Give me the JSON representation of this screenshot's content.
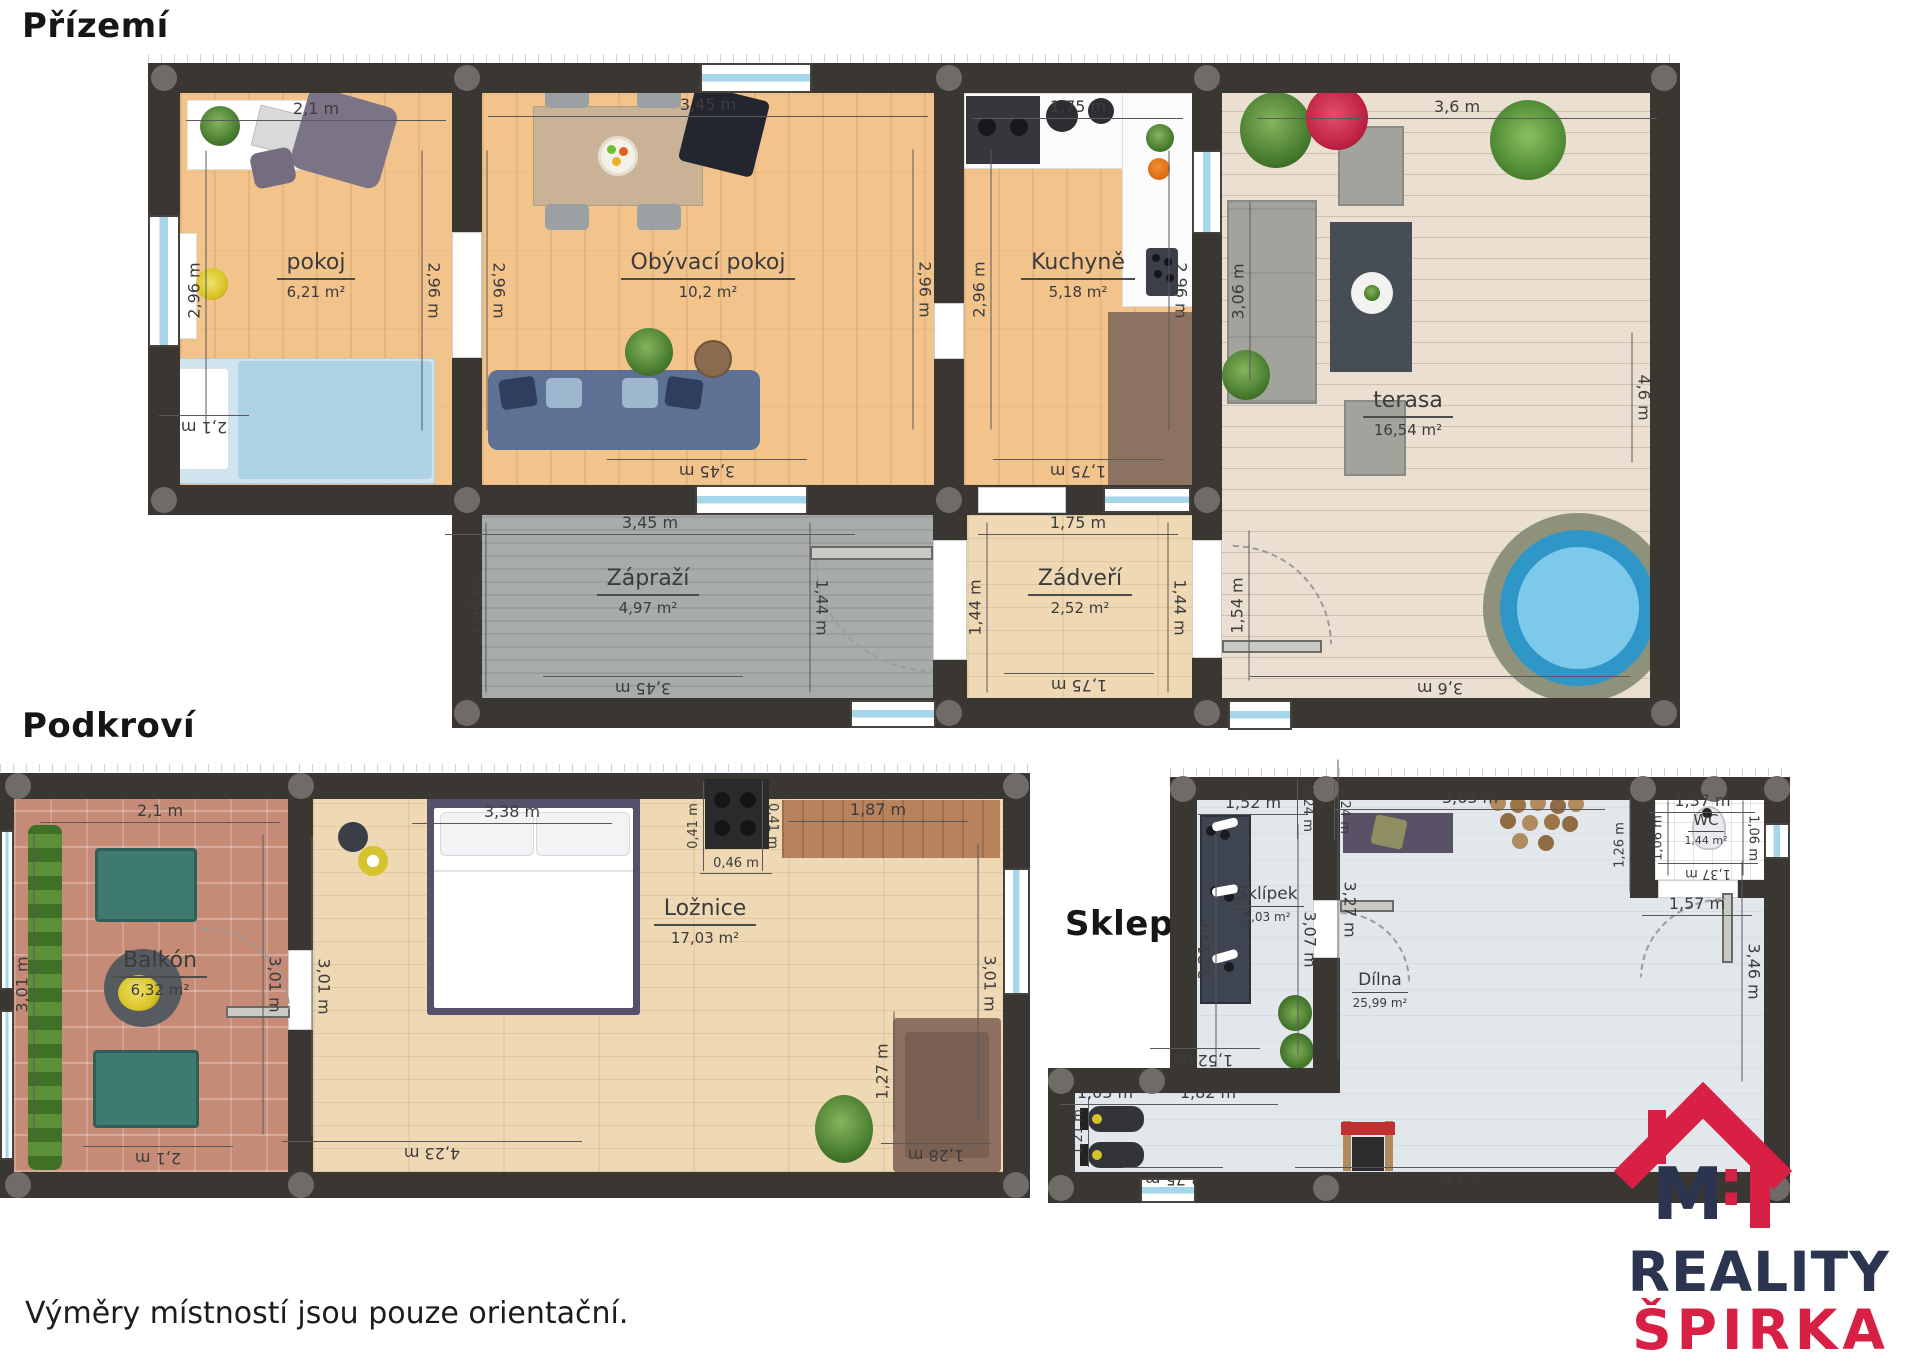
{
  "ground": {
    "title": "Přízemí",
    "rooms": {
      "pokoj": {
        "name": "pokoj",
        "area": "6,21 m²"
      },
      "obyvaci": {
        "name": "Obývací pokoj",
        "area": "10,2 m²"
      },
      "kuchyne": {
        "name": "Kuchyně",
        "area": "5,18 m²"
      },
      "terasa": {
        "name": "terasa",
        "area": "16,54 m²"
      },
      "zaprazi": {
        "name": "Zápraží",
        "area": "4,97 m²"
      },
      "zadveri": {
        "name": "Zádveří",
        "area": "2,52 m²"
      }
    },
    "dims": {
      "pokoj_top": "2,1 m",
      "pokoj_left": "2,96 m",
      "pokoj_right": "2,96 m",
      "pokoj_bottom": "2,1 m",
      "obyvaci_top": "3,45 m",
      "obyvaci_left": "2,96 m",
      "obyvaci_right": "2,96 m",
      "obyvaci_bottom": "3,45 m",
      "kuchyne_top": "1,75 m",
      "kuchyne_left": "2,96 m",
      "kuchyne_right": "2,96 m",
      "kuchyne_bottom": "1,75 m",
      "terasa_top": "3,6 m",
      "terasa_left": "3,06 m",
      "terasa_left_lower": "1,54 m",
      "terasa_right": "4,6 m",
      "terasa_bottom": "3,6 m",
      "zaprazi_top": "3,45 m",
      "zaprazi_left": "1,44 m",
      "zaprazi_right": "1,44 m",
      "zaprazi_bottom": "3,45 m",
      "zadveri_top": "1,75 m",
      "zadveri_left": "1,44 m",
      "zadveri_right": "1,44 m",
      "zadveri_bottom": "1,75 m"
    }
  },
  "attic": {
    "title": "Podkroví",
    "rooms": {
      "balkon": {
        "name": "Balkón",
        "area": "6,32 m²"
      },
      "loznice": {
        "name": "Ložnice",
        "area": "17,03 m²"
      }
    },
    "dims": {
      "balkon_top": "2,1 m",
      "balkon_left": "3,01 m",
      "balkon_right": "3,01 m",
      "balkon_bottom": "2,1 m",
      "loznice_left": "3,01 m",
      "bed_width": "3,38 m",
      "stove_left": "0,41 m",
      "stove_right": "0,41 m",
      "stove_width": "0,46 m",
      "shelf_width": "1,87 m",
      "loznice_right": "3,01 m",
      "loznice_bottom": "4,23 m",
      "chair_height": "1,27 m",
      "chair_width": "1,28 m"
    }
  },
  "basement": {
    "title": "Sklep",
    "rooms": {
      "sklipek": {
        "name": "Sklípek",
        "area": "5,03 m²"
      },
      "wc": {
        "name": "WC",
        "area": "1,44 m²"
      },
      "dilna": {
        "name": "Dílna",
        "area": "25,99 m²"
      }
    },
    "dims": {
      "sklipek_top": "1,52 m",
      "offset_left": "0,24 m",
      "offset_right": "0,24 m",
      "dilna_top": "3,63 m",
      "wc_top": "1,37 m",
      "wc_outer_left": "1,26 m",
      "wc_left": "1,06 m",
      "wc_right": "1,06 m",
      "wc_bottom": "1,37 m",
      "wc_door": "1,57 m",
      "sklipek_left": "3,21 m",
      "sklipek_right": "3,07 m",
      "dilna_left": "3,27 m",
      "sklipek_bottom": "1,52 m",
      "gym_top_left": "1,03 m",
      "gym_top_right": "1,82 m",
      "gym_left": "1,21 m",
      "gym_bottom": "2,75 m",
      "dilna_bottom": "5,3 m",
      "dilna_right": "3,46 m"
    }
  },
  "footer": {
    "disclaimer": "Výměry místností jsou pouze orientační."
  },
  "logo": {
    "line1": "REALITY",
    "line2": "ŠPIRKA",
    "monogram": "M",
    "colon": ":"
  },
  "colors": {
    "wall": "#3a3733",
    "logo_navy": "#2b3550",
    "logo_red": "#d81f44",
    "window_blue": "#a5d6ea"
  }
}
